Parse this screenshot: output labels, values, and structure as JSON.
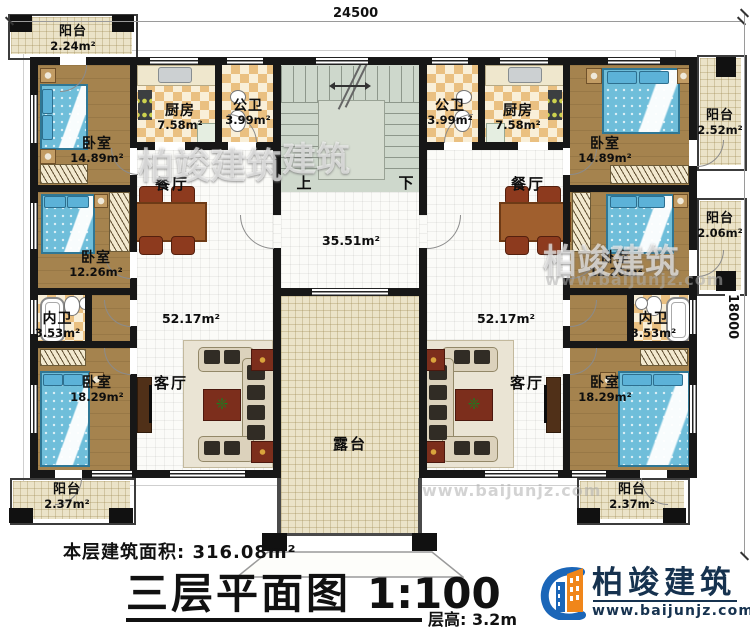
{
  "dimensions": {
    "width_label": "24500",
    "height_label": "18000"
  },
  "stair": {
    "up": "上",
    "down": "下"
  },
  "hall": {
    "area": "35.51m²"
  },
  "rooms": {
    "balcony_tl": {
      "name": "阳台",
      "area": "2.24m²"
    },
    "bedroom1_left": {
      "name": "卧室",
      "area": "14.89m²"
    },
    "kitchen_left": {
      "name": "厨房",
      "area": "7.58m²"
    },
    "bath_left": {
      "name": "公卫",
      "area": "3.99m²"
    },
    "dining_left": {
      "name": "餐厅"
    },
    "bedroom2_left": {
      "name": "卧室",
      "area": "12.26m²"
    },
    "ensuite_left": {
      "name": "内卫",
      "area": "3.53m²"
    },
    "bedroom3_left": {
      "name": "卧室",
      "area": "18.29m²"
    },
    "living_left": {
      "name": "客厅",
      "area": "52.17m²"
    },
    "balcony_bl": {
      "name": "阳台",
      "area": "2.37m²"
    },
    "bath_right": {
      "name": "公卫",
      "area": "3.99m²"
    },
    "kitchen_right": {
      "name": "厨房",
      "area": "7.58m²"
    },
    "bedroom1_right": {
      "name": "卧室",
      "area": "14.89m²"
    },
    "balcony_r1": {
      "name": "阳台",
      "area": "2.52m²"
    },
    "dining_right": {
      "name": "餐厅"
    },
    "bedroom2_right": {
      "name": "卧室",
      "area": "12.26m²"
    },
    "balcony_r2": {
      "name": "阳台",
      "area": "2.06m²"
    },
    "ensuite_right": {
      "name": "内卫",
      "area": "3.53m²"
    },
    "living_right": {
      "name": "客厅",
      "area": "52.17m²"
    },
    "bedroom3_right": {
      "name": "卧室",
      "area": "18.29m²"
    },
    "balcony_br": {
      "name": "阳台",
      "area": "2.37m²"
    },
    "terrace": {
      "name": "露台"
    }
  },
  "footer": {
    "floor_area": "本层建筑面积: 316.08m²",
    "title": "三层平面图",
    "scale": "1:100",
    "floor_height": "层高: 3.2m"
  },
  "logo": {
    "name": "柏竣建筑",
    "url": "www.baijunjz.com"
  },
  "watermarks": {
    "brand": "柏竣建筑",
    "url": "www.baijunjz.com",
    "partial": "建筑"
  }
}
